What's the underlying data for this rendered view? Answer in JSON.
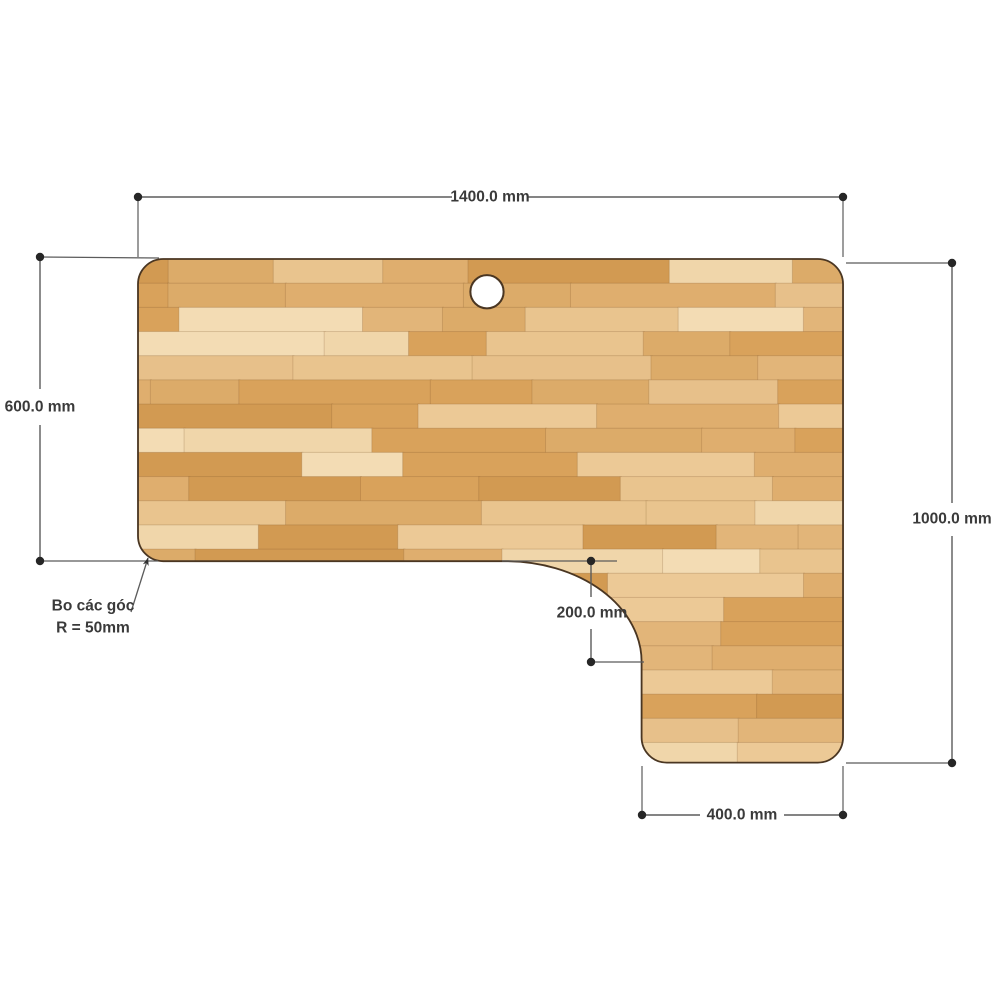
{
  "page": {
    "background": "#ffffff"
  },
  "drawing": {
    "subject": "L-shaped wooden desktop panel, top view with dimensions",
    "dimensions": {
      "top_width": "1400.0 mm",
      "left_height": "600.0 mm",
      "right_height": "1000.0 mm",
      "notch_height": "200.0 mm",
      "bottom_extension_width": "400.0 mm"
    },
    "corner_note": {
      "line1": "Bo các góc",
      "line2": "R = 50mm"
    },
    "colors": {
      "page_background": "#ffffff",
      "dimension_line": "#5b5b5b",
      "dimension_text": "#3a3a3a",
      "desk_outline": "#4a3622",
      "wood_base": "#e6bb80",
      "hole_fill": "#ffffff"
    },
    "wood_palette": [
      "#f0d6aa",
      "#ecc996",
      "#e7c08a",
      "#e2b579",
      "#dcab69",
      "#d9a25b",
      "#d29a52",
      "#f3dcb4",
      "#e9c48e",
      "#dfae6e"
    ]
  }
}
